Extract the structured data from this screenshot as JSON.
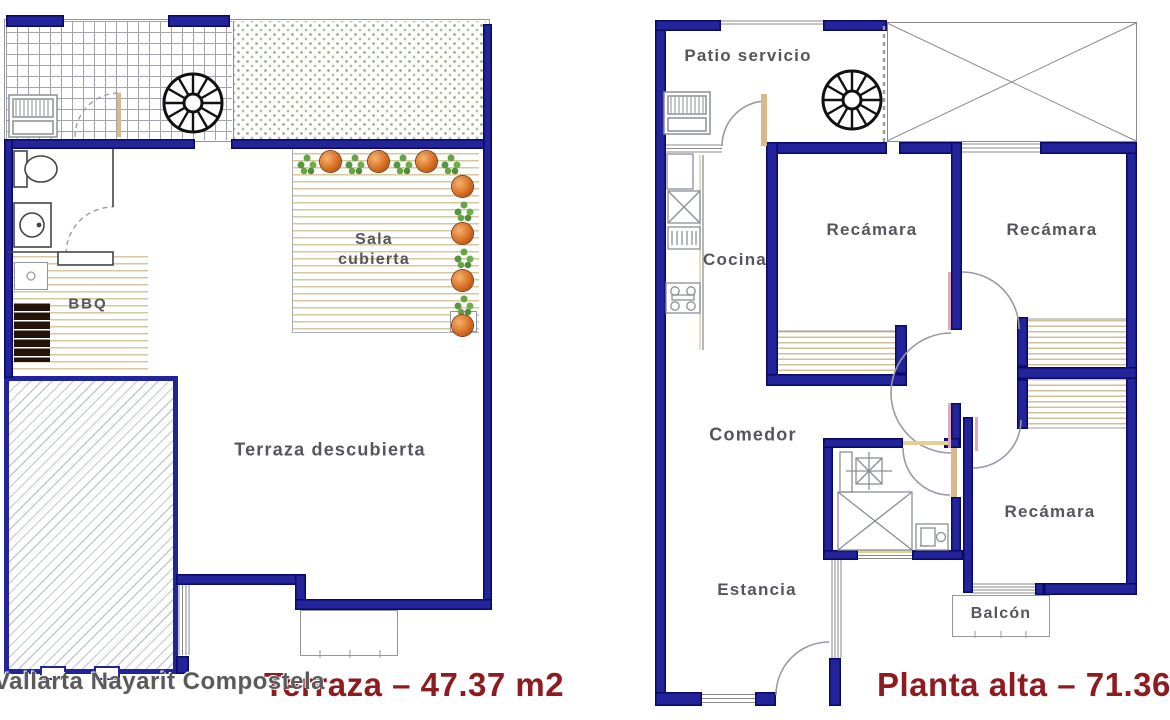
{
  "left_plan": {
    "title": "Terraza – 47.37 m2",
    "rooms": {
      "sala_line1": "Sala",
      "sala_line2": "cubierta",
      "bbq": "BBQ",
      "terraza": "Terraza descubierta"
    }
  },
  "right_plan": {
    "title": "Planta alta – 71.36 m",
    "rooms": {
      "patio": "Patio servicio",
      "cocina": "Cocina",
      "recamara_1": "Recámara",
      "recamara_2": "Recámara",
      "recamara_3": "Recámara",
      "comedor": "Comedor",
      "estancia": "Estancia",
      "balcon": "Balcón"
    }
  },
  "watermark": "Vallarta Nayarit Compostela",
  "colors": {
    "wall_blue": "#23239a",
    "title_red": "#8e1b1f",
    "label_gray": "#54565c",
    "deck_tan": "#d6c79f"
  }
}
